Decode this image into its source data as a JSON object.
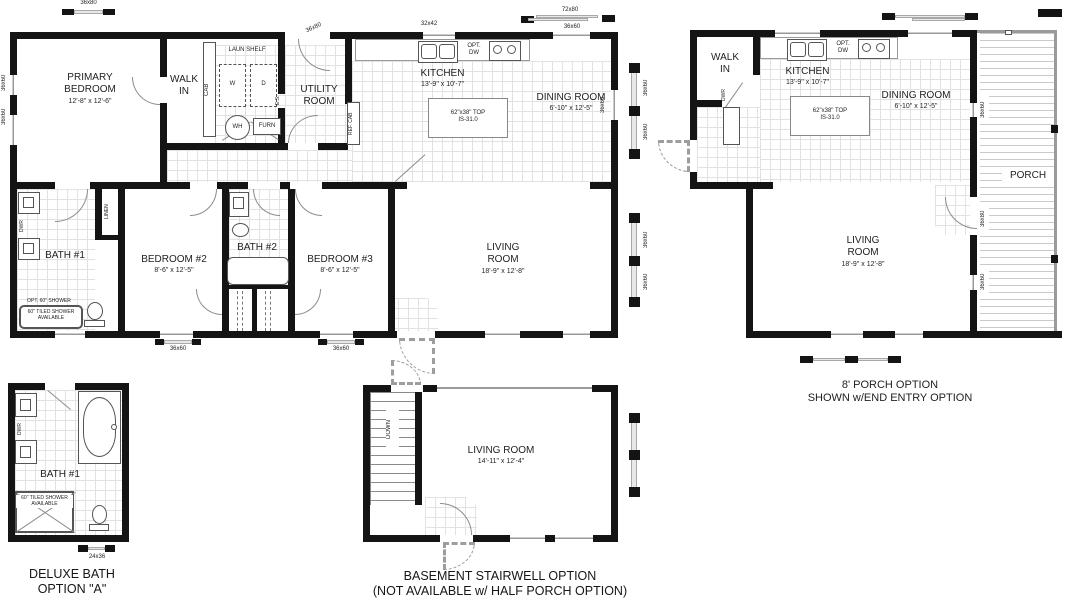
{
  "dims": {
    "d36x80": "36x80",
    "d32x42": "32x42",
    "d72x80": "72x80",
    "d36x60": "36x60",
    "d24x36": "24x36"
  },
  "main": {
    "primary": {
      "name": "PRIMARY\nBEDROOM",
      "size": "12'-8\" x 12'-6\""
    },
    "walk_in": "WALK\nIN",
    "cab": "CAB",
    "laun_shelf": "LAUN SHELF",
    "washer": "W",
    "dryer": "D",
    "es": "E.S.",
    "utility": "UTILITY\nROOM",
    "wh": "WH",
    "furn": "FURN",
    "ref_cab": "REF. CAB",
    "kitchen": {
      "name": "KITCHEN",
      "size": "13'-9\" x 10'-7\""
    },
    "opt_dw": "OPT.\nDW",
    "dining": {
      "name": "DINING ROOM",
      "size": "6'-10\" x 12'-5\""
    },
    "island": "62\"x38\" TOP\nIS-31.0",
    "bath1": "BATH #1",
    "dwr": "DWR",
    "linen": "LINEN",
    "opt_shower": "OPT. 60\" SHOWER",
    "tiled_shower": "60\" TILED SHOWER\nAVAILABLE",
    "bedroom2": {
      "name": "BEDROOM #2",
      "size": "8'-6\" x 12'-5\""
    },
    "bath2": "BATH #2",
    "bedroom3": {
      "name": "BEDROOM #3",
      "size": "8'-6\" x 12'-5\""
    },
    "living": {
      "name": "LIVING\nROOM",
      "size": "18'-9\" x 12'-8\""
    }
  },
  "porch_plan": {
    "walk_in": "WALK\nIN",
    "dwr": "DWR",
    "kitchen": {
      "name": "KITCHEN",
      "size": "13'-9\" x 10'-7\""
    },
    "opt_dw": "OPT.\nDW",
    "dining": {
      "name": "DINING ROOM",
      "size": "6'-10\" x 12'-5\""
    },
    "island": "62\"x38\" TOP\nIS-31.0",
    "living": {
      "name": "LIVING\nROOM",
      "size": "18'-9\" x 12'-8\""
    },
    "porch": "PORCH",
    "caption": "8' PORCH OPTION\nSHOWN w/END ENTRY OPTION"
  },
  "bath_option": {
    "bath1": "BATH #1",
    "dwr": "DWR",
    "tiled_shower": "60\" TILED SHOWER\nAVAILABLE",
    "caption": "DELUXE BATH\nOPTION \"A\""
  },
  "basement_option": {
    "down": "DOWN",
    "living": {
      "name": "LIVING ROOM",
      "size": "14'-11\" x 12'-4\""
    },
    "caption": "BASEMENT STAIRWELL OPTION\n(NOT AVAILABLE w/ HALF PORCH OPTION)"
  }
}
